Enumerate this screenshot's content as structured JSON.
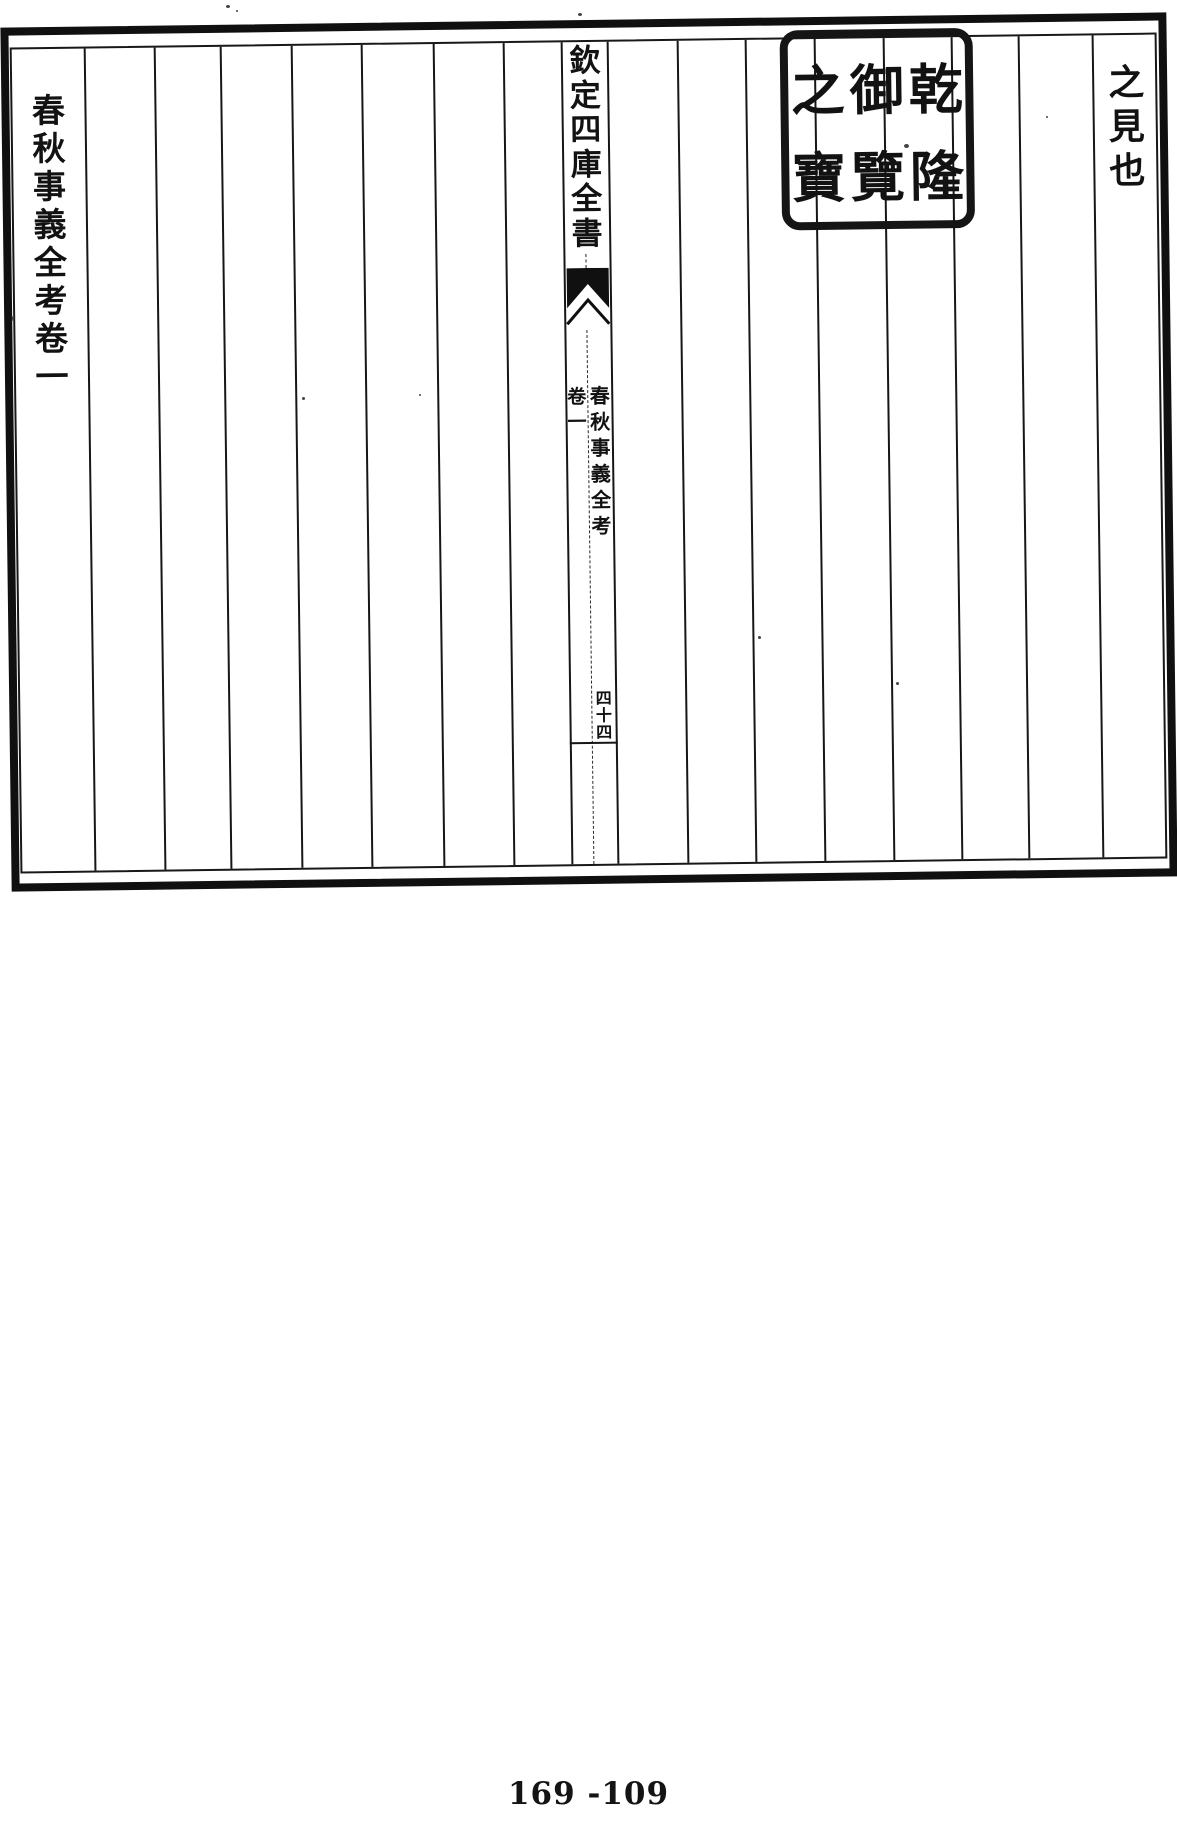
{
  "document": {
    "frame": {
      "header_title": "欽定四庫全書",
      "right_column_text": "之見也",
      "left_column_title": "春秋事義全考卷一",
      "gutter": {
        "book_title": "春秋事義全考",
        "juan_label": "卷一",
        "folio_number": "四十四"
      },
      "seal": {
        "full_text": "乾隆御覽之寶",
        "column_right": "乾隆",
        "column_middle": "御覽",
        "column_left": "之寶"
      }
    },
    "footer": {
      "page_number": "169 -109"
    },
    "colors": {
      "ink": "#121212",
      "paper": "#ffffff"
    }
  }
}
